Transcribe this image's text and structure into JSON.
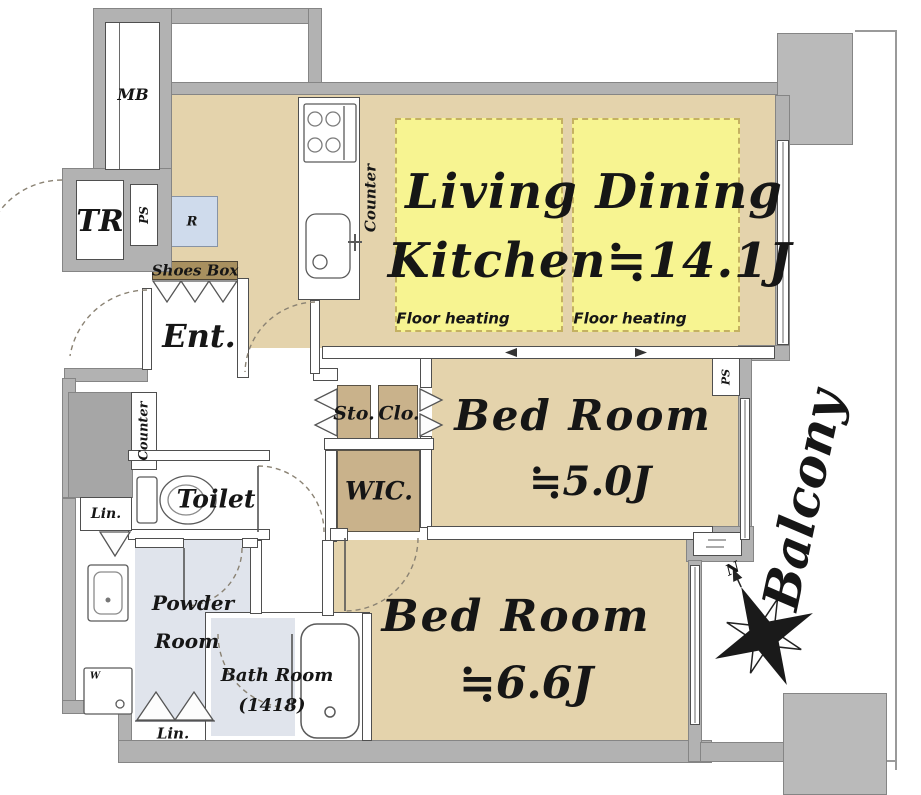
{
  "rooms": {
    "ldk": {
      "line1": "Living Dining",
      "line2": "Kitchen≒14.1J"
    },
    "bedroom1": {
      "name": "Bed Room",
      "area": "≒5.0J"
    },
    "bedroom2": {
      "name": "Bed Room",
      "area": "≒6.6J"
    },
    "entrance": "Ent.",
    "toilet": "Toilet",
    "powder": {
      "line1": "Powder",
      "line2": "Room"
    },
    "bath": {
      "line1": "Bath Room",
      "line2": "(1418)"
    },
    "wic": "WIC.",
    "storage": "Sto.",
    "closet": "Clo.",
    "balcony": "Balcony"
  },
  "labels": {
    "mb": "MB",
    "tr": "TR",
    "ps": "PS",
    "refrigerator": "R",
    "shoes_box": "Shoes Box",
    "counter": "Counter",
    "floor_heating": "Floor heating",
    "linen": "Lin.",
    "washer": "W",
    "north": "N"
  },
  "colors": {
    "floor_tan": "#e4d3ac",
    "closet_tan": "#c9b28b",
    "heating_yellow": "#f7f491",
    "wet_area_floor": "#e0e4ec",
    "wall_gray": "#b2b2b2",
    "refrigerator_blue": "#cfdbec",
    "shoes_box_brown": "#a8905f"
  }
}
